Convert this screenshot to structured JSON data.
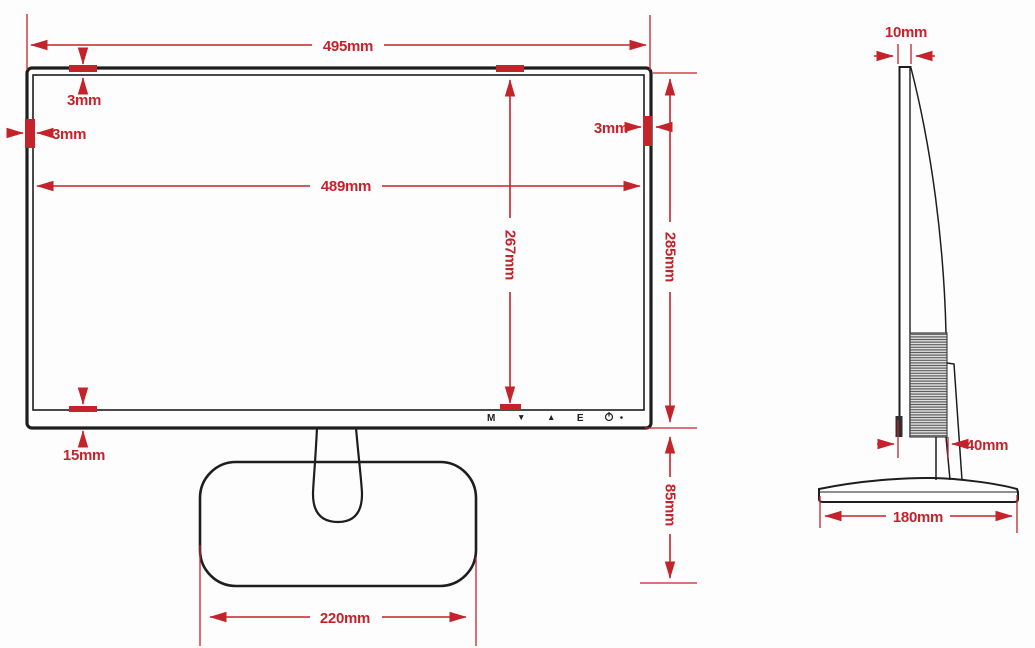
{
  "diagram": {
    "title": "Monitor dimensions diagram",
    "colors": {
      "dimension_red": "#c5232b",
      "outline_dark": "#1e1e1e",
      "background": "#ffffff"
    },
    "front_view": {
      "dim_total_width": "495mm",
      "dim_active_width": "489mm",
      "dim_total_height": "285mm",
      "dim_active_height": "267mm",
      "dim_bezel_top": "3mm",
      "dim_bezel_left": "3mm",
      "dim_bezel_right": "3mm",
      "dim_bezel_bottom": "15mm",
      "dim_stand_height": "85mm",
      "dim_base_width": "220mm",
      "buttons": {
        "menu": "M",
        "down": "▼",
        "up": "▲",
        "exit": "E"
      }
    },
    "side_view": {
      "dim_panel_thickness": "10mm",
      "dim_body_depth": "40mm",
      "dim_base_depth": "180mm"
    }
  }
}
